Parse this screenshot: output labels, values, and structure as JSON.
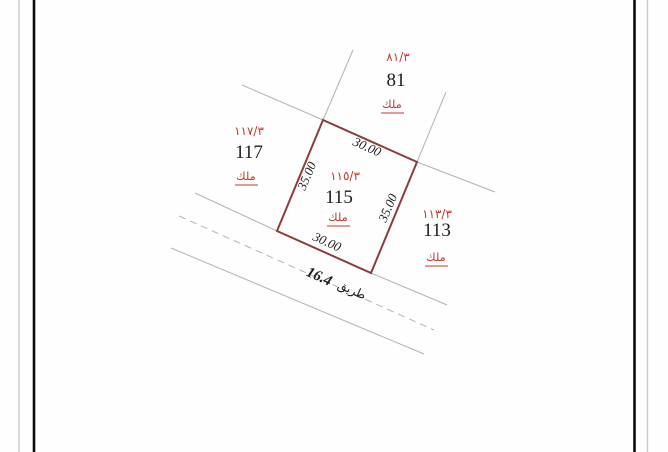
{
  "colors": {
    "outline_red": "#8e3b3b",
    "label_red": "#c23b2e",
    "line_gray": "#b9b1b1",
    "ink_black": "#1c1c1c"
  },
  "plots": {
    "center": {
      "parcel_no": "١١٥/٣",
      "number": "115",
      "tenure": "ملك",
      "dim_top": "30.00",
      "dim_bottom": "30.00",
      "dim_left": "35.00",
      "dim_right": "35.00"
    },
    "north": {
      "parcel_no": "٨١/٣",
      "number": "81",
      "tenure": "ملك"
    },
    "west": {
      "parcel_no": "١١٧/٣",
      "number": "117",
      "tenure": "ملك"
    },
    "east": {
      "parcel_no": "١١٣/٣",
      "number": "113",
      "tenure": "ملك"
    }
  },
  "road": {
    "label": "طريق",
    "width": "16.4"
  }
}
